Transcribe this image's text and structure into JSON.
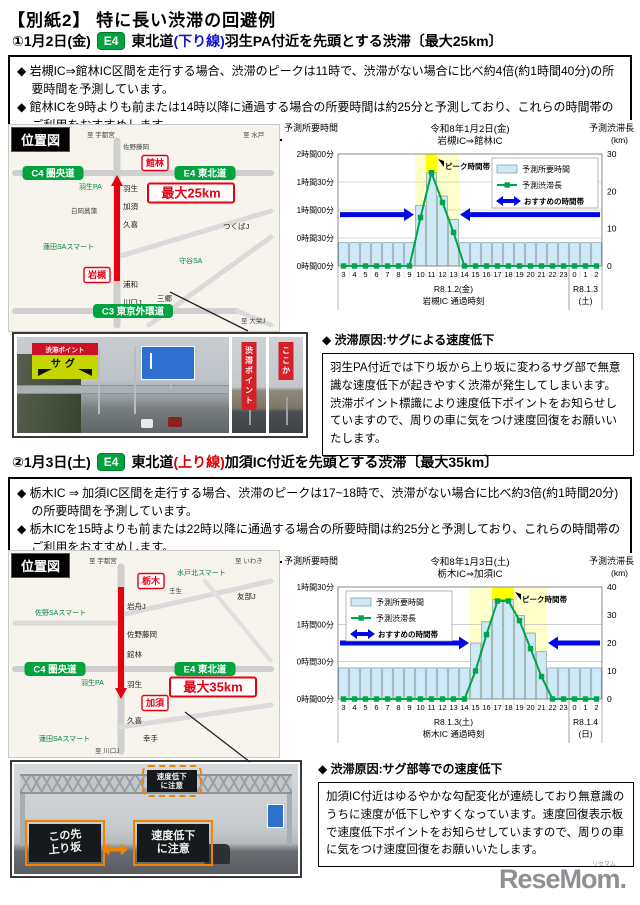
{
  "page": {
    "title": "【別紙2】 特に長い渋滞の回避例"
  },
  "footer": {
    "logo": "ReseMom.",
    "logo_ruby": "リセマム"
  },
  "sections": [
    {
      "header": {
        "number_date": "①1月2日(金)",
        "badge": "E4",
        "route": "東北道",
        "direction": "(下り線)",
        "direction_color": "#1414c8",
        "tail": "羽生PA付近を先頭とする渋滞〔最大25km〕"
      },
      "bullets": [
        "◆ 岩槻IC⇒館林IC区間を走行する場合、渋滞のピークは11時で、渋滞がない場合に比べ約4倍(約1時間40分)の所要時間を予測しています。",
        "◆ 館林ICを9時よりも前または14時以降に通過する場合の所要時間は約25分と予測しており、これらの時間帯のご利用をおすすめします。"
      ],
      "map": {
        "title": "位置図",
        "bg": "#f6f4ec",
        "roads": [
          {
            "pts": [
              [
                108,
                16
              ],
              [
                108,
                200
              ]
            ],
            "w": 7,
            "c": "#cfcfcf"
          },
          {
            "pts": [
              [
                6,
                48
              ],
              [
                262,
                48
              ]
            ],
            "w": 6,
            "c": "#cfcfcf"
          },
          {
            "pts": [
              [
                6,
                186
              ],
              [
                228,
                186
              ]
            ],
            "w": 6,
            "c": "#cfcfcf"
          },
          {
            "pts": [
              [
                108,
                132
              ],
              [
                262,
                86
              ]
            ],
            "w": 5,
            "c": "#dadada"
          },
          {
            "pts": [
              [
                140,
                200
              ],
              [
                262,
                112
              ]
            ],
            "w": 5,
            "c": "#dadada"
          },
          {
            "pts": [
              [
                228,
                186
              ],
              [
                262,
                200
              ]
            ],
            "w": 5,
            "c": "#dadada"
          }
        ],
        "arrow": {
          "x": 108,
          "from": 156,
          "to": 50,
          "color": "#e60012"
        },
        "labels": [
          {
            "t": "至 宇都宮",
            "s": "tiny",
            "x": 78,
            "y": 12
          },
          {
            "t": "至 水戸",
            "s": "tiny",
            "x": 234,
            "y": 12
          },
          {
            "t": "佐野藤岡",
            "s": "tiny",
            "x": 114,
            "y": 24
          },
          {
            "t": "館林",
            "s": "redbox",
            "x": 146,
            "y": 38
          },
          {
            "t": "C4 圏央道",
            "s": "badge",
            "x": 44,
            "y": 48
          },
          {
            "t": "E4 東北道",
            "s": "badge",
            "x": 196,
            "y": 48
          },
          {
            "t": "羽生PA",
            "s": "green",
            "x": 70,
            "y": 64
          },
          {
            "t": "羽生",
            "s": "name",
            "x": 114,
            "y": 66
          },
          {
            "t": "最大25km",
            "s": "redboxbig",
            "x": 182,
            "y": 68
          },
          {
            "t": "加須",
            "s": "name",
            "x": 114,
            "y": 84
          },
          {
            "t": "白岡菖蒲",
            "s": "tiny",
            "x": 62,
            "y": 88
          },
          {
            "t": "久喜",
            "s": "name",
            "x": 114,
            "y": 102
          },
          {
            "t": "つくばJ",
            "s": "name",
            "x": 214,
            "y": 104
          },
          {
            "t": "蓮田SAスマート",
            "s": "green",
            "x": 34,
            "y": 124
          },
          {
            "t": "守谷SA",
            "s": "green",
            "x": 170,
            "y": 138
          },
          {
            "t": "岩槻",
            "s": "redbox",
            "x": 88,
            "y": 150
          },
          {
            "t": "浦和",
            "s": "name",
            "x": 114,
            "y": 162
          },
          {
            "t": "三郷",
            "s": "name",
            "x": 148,
            "y": 176
          },
          {
            "t": "川口J",
            "s": "name",
            "x": 114,
            "y": 180
          },
          {
            "t": "C3 東京外環道",
            "s": "badge",
            "x": 124,
            "y": 186
          },
          {
            "t": "至 大栄J",
            "s": "tiny",
            "x": 232,
            "y": 198
          }
        ]
      },
      "photo": {
        "jam_banner": "渋滞ポイント",
        "sag_sign": "サグ",
        "side_banner_1": "渋滞ポイント",
        "side_banner_2": "ここか"
      },
      "cause": {
        "heading": "◆ 渋滞原因:サグによる速度低下",
        "body": "羽生PA付近では下り坂から上り坂に変わるサグ部で無意識な速度低下が起きやすく渋滞が発生してしまいます。渋滞ポイント標識により速度低下ポイントをお知らせしていますので、周りの車に気をつけ速度回復をお願いいたします。"
      }
    },
    {
      "header": {
        "number_date": "②1月3日(土)",
        "badge": "E4",
        "route": "東北道",
        "direction": "(上り線)",
        "direction_color": "#d80000",
        "tail": "加須IC付近を先頭とする渋滞〔最大35km〕"
      },
      "bullets": [
        "◆ 栃木IC ⇒ 加須IC区間を走行する場合、渋滞のピークは17~18時で、渋滞がない場合に比べ約3倍(約1時間20分)の所要時間を予測しています。",
        "◆ 栃木ICを15時よりも前または22時以降に通過する場合の所要時間は約25分と予測しており、これらの時間帯のご利用をおすすめします。"
      ],
      "map": {
        "title": "位置図",
        "bg": "#f6f4ec",
        "roads": [
          {
            "pts": [
              [
                112,
                16
              ],
              [
                112,
                200
              ]
            ],
            "w": 7,
            "c": "#cfcfcf"
          },
          {
            "pts": [
              [
                6,
                72
              ],
              [
                112,
                72
              ]
            ],
            "w": 5,
            "c": "#dadada"
          },
          {
            "pts": [
              [
                112,
                64
              ],
              [
                262,
                30
              ]
            ],
            "w": 5,
            "c": "#dadada"
          },
          {
            "pts": [
              [
                6,
                118
              ],
              [
                262,
                118
              ]
            ],
            "w": 6,
            "c": "#cfcfcf"
          },
          {
            "pts": [
              [
                112,
                176
              ],
              [
                262,
                154
              ]
            ],
            "w": 5,
            "c": "#dadada"
          },
          {
            "pts": [
              [
                196,
                30
              ],
              [
                262,
                110
              ]
            ],
            "w": 4,
            "c": "#e0e0e0"
          }
        ],
        "arrow": {
          "x": 112,
          "from": 36,
          "to": 148,
          "color": "#e60012"
        },
        "labels": [
          {
            "t": "至 宇都宮",
            "s": "tiny",
            "x": 80,
            "y": 12
          },
          {
            "t": "至 いわき",
            "s": "tiny",
            "x": 226,
            "y": 12
          },
          {
            "t": "栃木都賀J",
            "s": "tiny",
            "x": 30,
            "y": 26
          },
          {
            "t": "栃木",
            "s": "redbox",
            "x": 142,
            "y": 30
          },
          {
            "t": "水戸北スマート",
            "s": "green",
            "x": 168,
            "y": 24
          },
          {
            "t": "壬生",
            "s": "tiny",
            "x": 160,
            "y": 42
          },
          {
            "t": "岩舟J",
            "s": "name",
            "x": 118,
            "y": 58
          },
          {
            "t": "佐野SAスマート",
            "s": "green",
            "x": 26,
            "y": 64
          },
          {
            "t": "友部J",
            "s": "name",
            "x": 228,
            "y": 48
          },
          {
            "t": "佐野藤岡",
            "s": "name",
            "x": 118,
            "y": 86
          },
          {
            "t": "館林",
            "s": "name",
            "x": 118,
            "y": 106
          },
          {
            "t": "C4 圏央道",
            "s": "badge",
            "x": 46,
            "y": 118
          },
          {
            "t": "E4 東北道",
            "s": "badge",
            "x": 196,
            "y": 118
          },
          {
            "t": "羽生PA",
            "s": "green",
            "x": 72,
            "y": 134
          },
          {
            "t": "羽生",
            "s": "name",
            "x": 118,
            "y": 136
          },
          {
            "t": "最大35km",
            "s": "redboxbig",
            "x": 204,
            "y": 136
          },
          {
            "t": "加須",
            "s": "redbox",
            "x": 146,
            "y": 152
          },
          {
            "t": "久喜",
            "s": "name",
            "x": 118,
            "y": 172
          },
          {
            "t": "蓮田SAスマート",
            "s": "green",
            "x": 30,
            "y": 190
          },
          {
            "t": "幸手",
            "s": "name",
            "x": 134,
            "y": 190
          },
          {
            "t": "至 川口J",
            "s": "tiny",
            "x": 86,
            "y": 202
          }
        ]
      },
      "photo": {
        "gantry_line1": "速度低下",
        "gantry_line2": "に注意",
        "left_sign_line1": "この先",
        "left_sign_line2": "上り坂",
        "right_sign_line1": "速度低下",
        "right_sign_line2": "に注意"
      },
      "cause": {
        "heading": "◆ 渋滞原因:サグ部等での速度低下",
        "body": "加須IC付近はゆるやかな勾配変化が連続しており無意識のうちに速度が低下しやすくなっています。速度回復表示板で速度低下ポイントをお知らせしていますので、周りの車に気をつけ速度回復をお願いいたします。"
      }
    }
  ],
  "chart_data": [
    {
      "type": "bar",
      "title": "令和8年1月2日(金) 岩槻IC⇒館林IC",
      "title_lines": [
        "令和8年1月2日(金)",
        "岩槻IC⇒館林IC"
      ],
      "categories": [
        "3",
        "4",
        "5",
        "6",
        "7",
        "8",
        "9",
        "10",
        "11",
        "12",
        "13",
        "14",
        "15",
        "16",
        "17",
        "18",
        "19",
        "20",
        "21",
        "22",
        "23",
        "0",
        "1",
        "2"
      ],
      "series": [
        {
          "name": "予測所要時間",
          "type": "bar",
          "axis": "left",
          "unit": "分",
          "values": [
            25,
            25,
            25,
            25,
            25,
            25,
            25,
            65,
            100,
            75,
            50,
            25,
            25,
            25,
            25,
            25,
            25,
            25,
            25,
            25,
            25,
            25,
            25,
            25
          ]
        },
        {
          "name": "予測渋滞長",
          "type": "line",
          "axis": "right",
          "unit": "km",
          "values": [
            0,
            0,
            0,
            0,
            0,
            0,
            0,
            13,
            25,
            17,
            9,
            0,
            0,
            0,
            0,
            0,
            0,
            0,
            0,
            0,
            0,
            0,
            0,
            0
          ]
        }
      ],
      "left_axis": {
        "title": "予測所要時間",
        "tick_labels": [
          "0時間00分",
          "0時間30分",
          "1時間00分",
          "1時間30分",
          "2時間00分"
        ],
        "step_min": 30,
        "max": 120
      },
      "right_axis": {
        "title": "予測渋滞長",
        "unit": "(km)",
        "ticks": [
          0,
          10,
          20,
          30
        ],
        "max": 30
      },
      "recommend_arrows": {
        "label": "おすすめの時間帯",
        "left_span": [
          0,
          7
        ],
        "right_span": [
          11,
          24
        ],
        "minutes": 55,
        "color": "#0008e6"
      },
      "peak_band": {
        "label": "ピーク時間帯",
        "span": [
          7,
          11
        ],
        "top_span": [
          8,
          9
        ],
        "top_minutes": 100,
        "band_color": "#ffffc9",
        "peak_color": "#ffff00"
      },
      "x_groups": [
        {
          "label_lines": [
            "R8.1.2(金)",
            "岩槻IC 通過時刻"
          ],
          "span": [
            0,
            21
          ]
        },
        {
          "label_lines": [
            "R8.1.3",
            "(土)"
          ],
          "span": [
            21,
            24
          ]
        }
      ],
      "legend_position": "top-right",
      "bar_color": "#cfe9f7",
      "line_color": "#00a44a",
      "grid": true
    },
    {
      "type": "bar",
      "title": "令和8年1月3日(土) 栃木IC⇒加須IC",
      "title_lines": [
        "令和8年1月3日(土)",
        "栃木IC⇒加須IC"
      ],
      "categories": [
        "3",
        "4",
        "5",
        "6",
        "7",
        "8",
        "9",
        "10",
        "11",
        "12",
        "13",
        "14",
        "15",
        "16",
        "17",
        "18",
        "19",
        "20",
        "21",
        "22",
        "23",
        "0",
        "1",
        "2"
      ],
      "series": [
        {
          "name": "予測所要時間",
          "type": "bar",
          "axis": "left",
          "unit": "分",
          "values": [
            25,
            25,
            25,
            25,
            25,
            25,
            25,
            25,
            25,
            25,
            25,
            25,
            45,
            62,
            80,
            80,
            67,
            53,
            38,
            25,
            25,
            25,
            25,
            25
          ]
        },
        {
          "name": "予測渋滞長",
          "type": "line",
          "axis": "right",
          "unit": "km",
          "values": [
            0,
            0,
            0,
            0,
            0,
            0,
            0,
            0,
            0,
            0,
            0,
            0,
            10,
            23,
            35,
            35,
            28,
            18,
            8,
            0,
            0,
            0,
            0,
            0
          ]
        }
      ],
      "left_axis": {
        "title": "予測所要時間",
        "tick_labels": [
          "0時間00分",
          "0時間30分",
          "1時間00分",
          "1時間30分"
        ],
        "step_min": 30,
        "max": 90
      },
      "right_axis": {
        "title": "予測渋滞長",
        "unit": "(km)",
        "ticks": [
          0,
          10,
          20,
          30,
          40
        ],
        "max": 40
      },
      "recommend_arrows": {
        "label": "おすすめの時間帯",
        "left_span": [
          0,
          12
        ],
        "right_span": [
          19,
          24
        ],
        "minutes": 45,
        "color": "#0008e6"
      },
      "peak_band": {
        "label": "ピーク時間帯",
        "span": [
          12,
          19
        ],
        "top_span": [
          14,
          16
        ],
        "top_minutes": 80,
        "band_color": "#ffffc9",
        "peak_color": "#ffff00"
      },
      "x_groups": [
        {
          "label_lines": [
            "R8.1.3(土)",
            "栃木IC 通過時刻"
          ],
          "span": [
            0,
            21
          ]
        },
        {
          "label_lines": [
            "R8.1.4",
            "(日)"
          ],
          "span": [
            21,
            24
          ]
        }
      ],
      "legend_position": "top-left",
      "bar_color": "#cfe9f7",
      "line_color": "#00a44a",
      "grid": true
    }
  ]
}
